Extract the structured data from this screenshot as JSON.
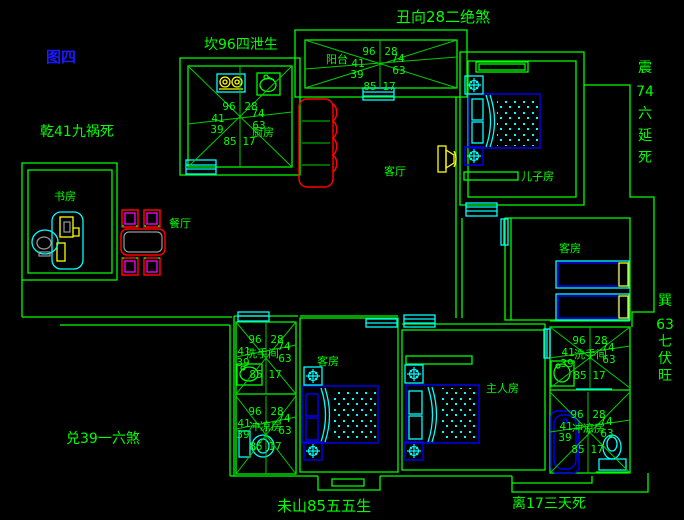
{
  "meta": {
    "width": 684,
    "height": 520,
    "background": "#000000"
  },
  "colors": {
    "wall": "#00ff00",
    "annotation_text": "#00ff00",
    "figure_label_blue": "#1a1aff",
    "fixture_cyan": "#00ffff",
    "furniture_blue": "#0000ee",
    "sofa_table_red": "#ff0000",
    "chair_magenta": "#ff00ff",
    "appliance_yellow": "#ffff00"
  },
  "annotations": {
    "figure_label": "图四",
    "top": "丑向28二绝煞",
    "kan": "坎96四泄生",
    "qian": "乾41九祸死",
    "dui": "兑39一六煞",
    "weishan": "未山85五五生",
    "li": "离17三天死",
    "zhen": [
      "震",
      "74",
      "六",
      "延",
      "死"
    ],
    "xun": [
      "巽",
      "63",
      "七",
      "伏",
      "旺"
    ]
  },
  "rooms": {
    "kitchen": "厨房",
    "balcony": "阳台",
    "living": "客厅",
    "son": "儿子房",
    "guest_right": "客房",
    "guest_bottom": "客房",
    "master": "主人房",
    "study": "书房",
    "dining": "餐厅",
    "bath_left_upper": "洗手间",
    "bath_left_lower": "冲凉房",
    "bath_right_upper": "洗手间",
    "bath_right_lower": "冲凉房"
  },
  "compass": {
    "top_l": "96",
    "top_r": "28",
    "mid_l": "41",
    "mid_r": "74",
    "low_l": "39",
    "low_r": "63",
    "bot_l": "85",
    "bot_r": "17"
  }
}
